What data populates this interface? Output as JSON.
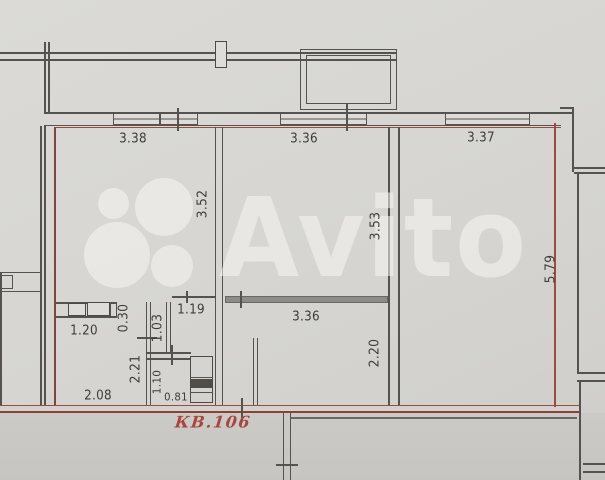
{
  "meta": {
    "width": 605,
    "height": 480,
    "type": "apartment-floor-plan"
  },
  "watermark": {
    "brand": "Avito"
  },
  "unit": {
    "label": "КВ.106"
  },
  "colors": {
    "paper": "#d7d6d2",
    "wall_line": "#56534e",
    "boundary_red": "#9c4a42",
    "gray_partition": "#8e8c87",
    "watermark": "rgba(247,246,242,0.55)",
    "dimension_text": "#3e3d3b",
    "unit_label_red": "#a8463d"
  },
  "dimensions": [
    {
      "id": "top-left-room-width",
      "value": "3.38",
      "orientation": "horizontal"
    },
    {
      "id": "top-middle-room-width",
      "value": "3.36",
      "orientation": "horizontal"
    },
    {
      "id": "top-right-room-width",
      "value": "3.37",
      "orientation": "horizontal"
    },
    {
      "id": "left-room-depth",
      "value": "3.52",
      "orientation": "vertical"
    },
    {
      "id": "middle-room-depth",
      "value": "3.53",
      "orientation": "vertical"
    },
    {
      "id": "right-room-depth",
      "value": "5.79",
      "orientation": "vertical"
    },
    {
      "id": "kitchen-units-width",
      "value": "1.20",
      "orientation": "horizontal"
    },
    {
      "id": "wall-stub-width",
      "value": "0.30",
      "orientation": "vertical"
    },
    {
      "id": "closet-width",
      "value": "1.03",
      "orientation": "vertical"
    },
    {
      "id": "hall-top-width",
      "value": "1.19",
      "orientation": "horizontal"
    },
    {
      "id": "middle-room-lower-width",
      "value": "3.36",
      "orientation": "horizontal"
    },
    {
      "id": "middle-room-lower-depth",
      "value": "2.20",
      "orientation": "vertical"
    },
    {
      "id": "hall-depth",
      "value": "2.21",
      "orientation": "vertical"
    },
    {
      "id": "bathroom-depth",
      "value": "1.10",
      "orientation": "vertical"
    },
    {
      "id": "bathroom-width",
      "value": "0.81",
      "orientation": "horizontal"
    },
    {
      "id": "hall-bottom-width",
      "value": "2.08",
      "orientation": "horizontal"
    }
  ]
}
